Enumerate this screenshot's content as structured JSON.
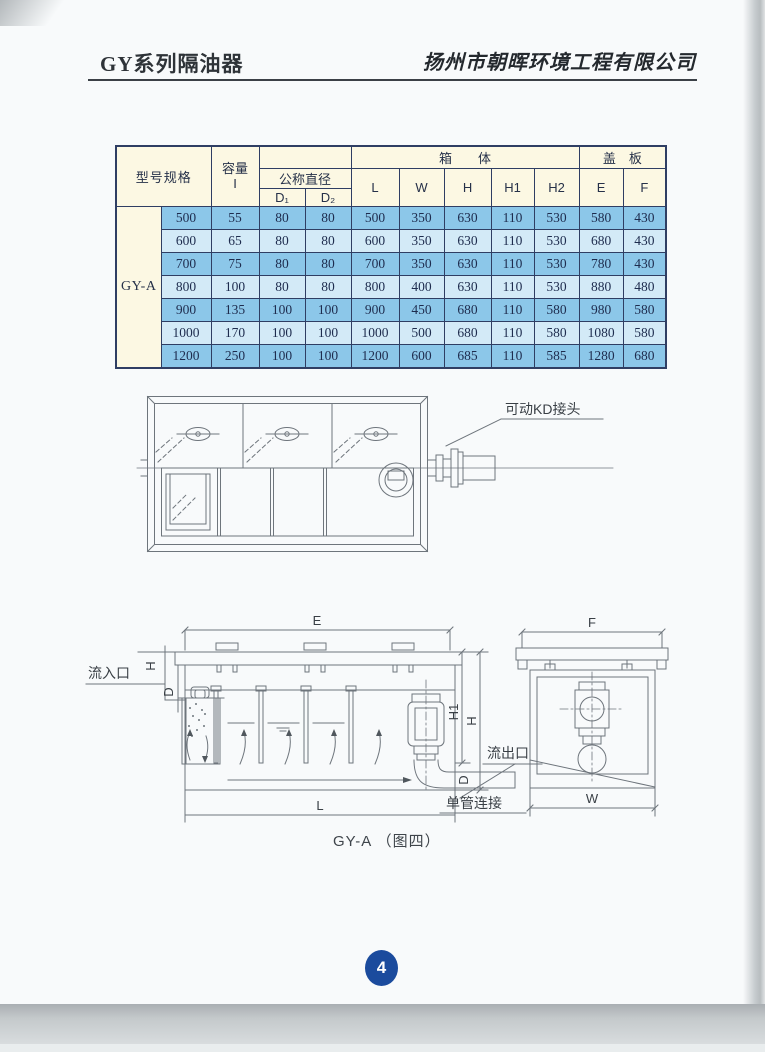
{
  "header": {
    "title": "GY系列隔油器",
    "company": "扬州市朝晖环境工程有限公司"
  },
  "table": {
    "col_groups": {
      "box": "箱　　体",
      "cover": "盖　板"
    },
    "headers": {
      "model": "型号规格",
      "capacity": "容量\nI",
      "nominal_diameter": "公称直径",
      "d1": "D₁",
      "d2": "D₂",
      "l": "L",
      "w": "W",
      "h": "H",
      "h1": "H1",
      "h2": "H2",
      "e": "E",
      "f": "F"
    },
    "model_label": "GY-A",
    "rows": [
      [
        "500",
        "55",
        "80",
        "80",
        "500",
        "350",
        "630",
        "110",
        "530",
        "580",
        "430"
      ],
      [
        "600",
        "65",
        "80",
        "80",
        "600",
        "350",
        "630",
        "110",
        "530",
        "680",
        "430"
      ],
      [
        "700",
        "75",
        "80",
        "80",
        "700",
        "350",
        "630",
        "110",
        "530",
        "780",
        "430"
      ],
      [
        "800",
        "100",
        "80",
        "80",
        "800",
        "400",
        "630",
        "110",
        "530",
        "880",
        "480"
      ],
      [
        "900",
        "135",
        "100",
        "100",
        "900",
        "450",
        "680",
        "110",
        "580",
        "980",
        "580"
      ],
      [
        "1000",
        "170",
        "100",
        "100",
        "1000",
        "500",
        "680",
        "110",
        "580",
        "1080",
        "580"
      ],
      [
        "1200",
        "250",
        "100",
        "100",
        "1200",
        "600",
        "685",
        "110",
        "585",
        "1280",
        "680"
      ]
    ]
  },
  "plan_view": {
    "label_movable_joint": "可动KD接头"
  },
  "section_view": {
    "dims": {
      "e": "E",
      "f": "F",
      "h_inlet": "H",
      "d_inlet": "D",
      "h1": "H1",
      "h": "H",
      "d_outlet": "D",
      "l": "L",
      "w": "W"
    },
    "labels": {
      "inlet": "流入口",
      "outlet": "流出口",
      "single_pipe": "单管连接"
    },
    "caption": "GY-A （图四）"
  },
  "footer": {
    "page_number": "4"
  },
  "colors": {
    "row_blue": "#8cc7e9",
    "row_light": "#d3eaf7",
    "header_cream": "#fcf8e3",
    "table_border": "#2f3e63",
    "page_badge": "#1b4b9d"
  }
}
